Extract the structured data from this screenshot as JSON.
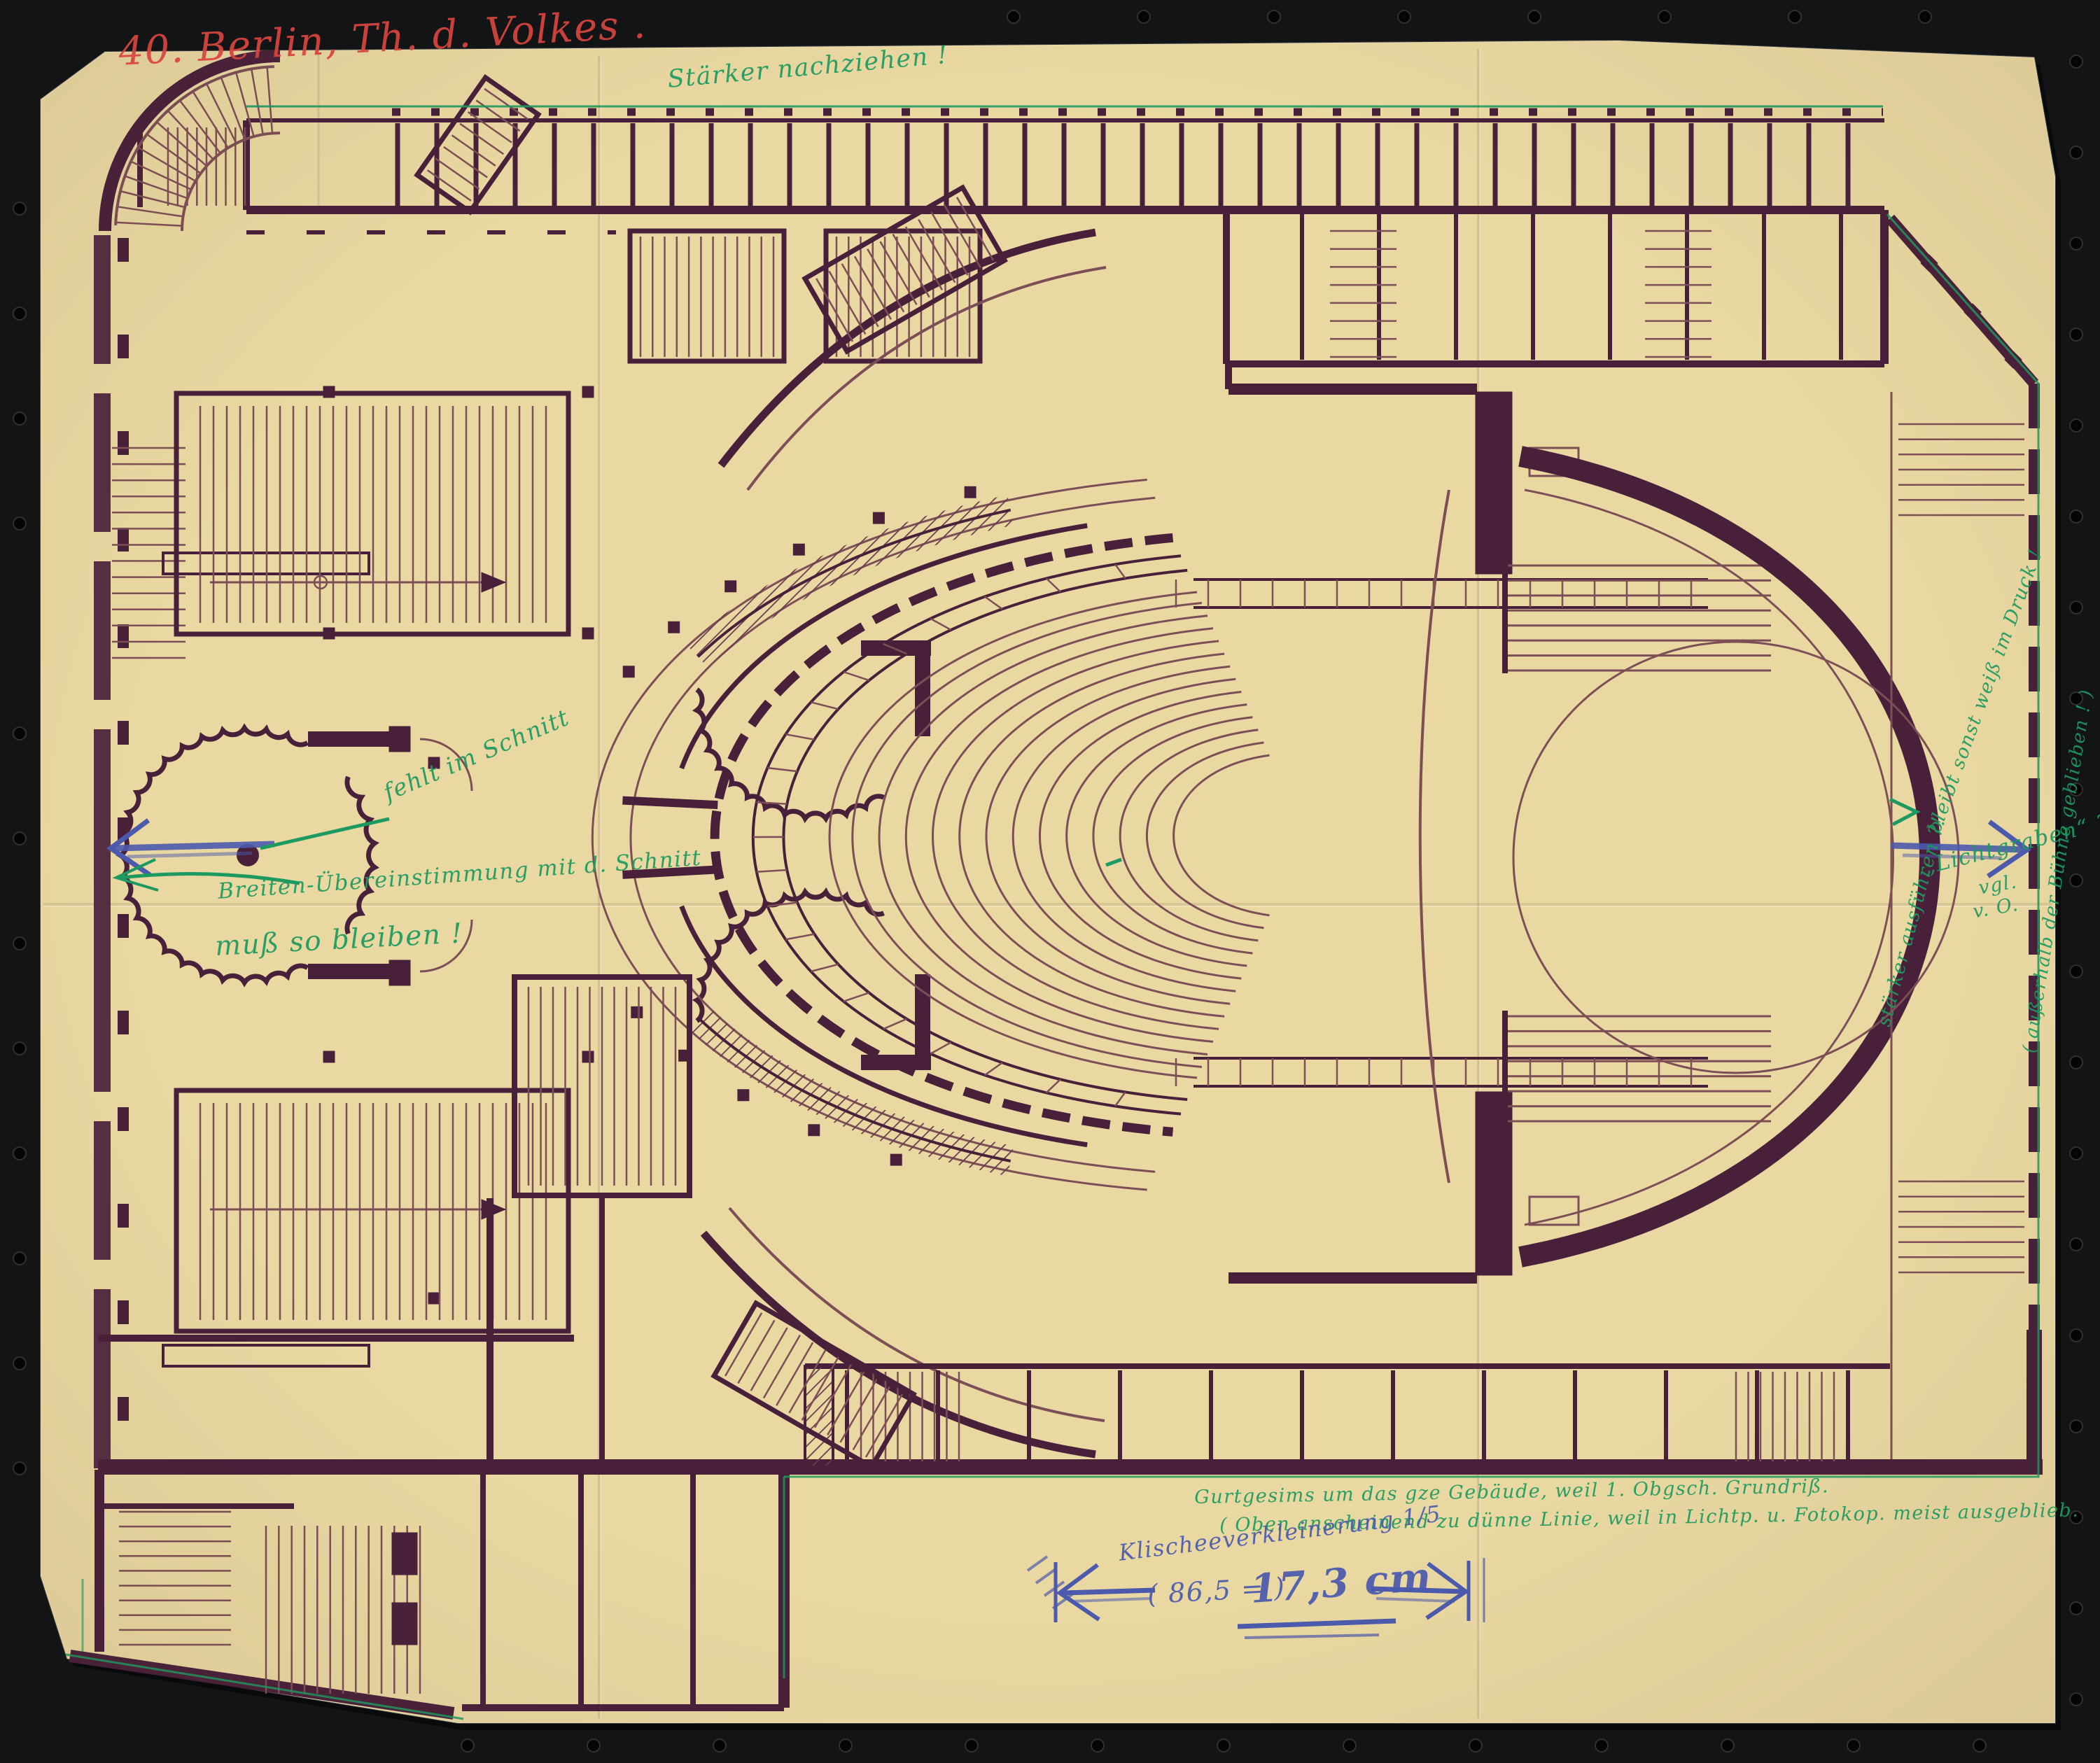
{
  "scan": {
    "background_color": "#131416",
    "paper_color": "#e9d8a2",
    "ink_color": "#48203a",
    "fine_line_color": "#7d4e55",
    "red": "#d8453e",
    "green": "#1d9a60",
    "blue": "#4b5aad"
  },
  "annotations": {
    "catalog_number": "40. Berlin, Th. d. Volkes .",
    "top_note": "Stärker nachziehen !",
    "missing_in_section": "fehlt im Schnitt",
    "agreement_note": "Breiten-Übereinstimmung mit d. Schnitt",
    "must_stay": "muß so bleiben !",
    "cornice_note_line1": "Gurtgesims um das gze Gebäude, weil 1. Obgsch. Grundriß.",
    "cornice_note_line2": "( Oben anscheinend zu dünne Linie, weil in Lichtp. u. Fotokop. meist ausgeblieb.",
    "reduction_note": "Klischeeverkleinerung 1/5",
    "dimension_prefix": "( 86,5 = )",
    "dimension_value": "17,3 cm",
    "stage_note_execute": "stärker ausführen ?!",
    "stage_note_print": "bleibt sonst weiß im Druck !",
    "stage_note_lichtgraben": "„Lichtgraben“  ?",
    "stage_note_vgl": "vgl.",
    "stage_note_vo": "v. O.",
    "stage_note_outside": "( außerhalb der Bühne geblieben ! )"
  }
}
